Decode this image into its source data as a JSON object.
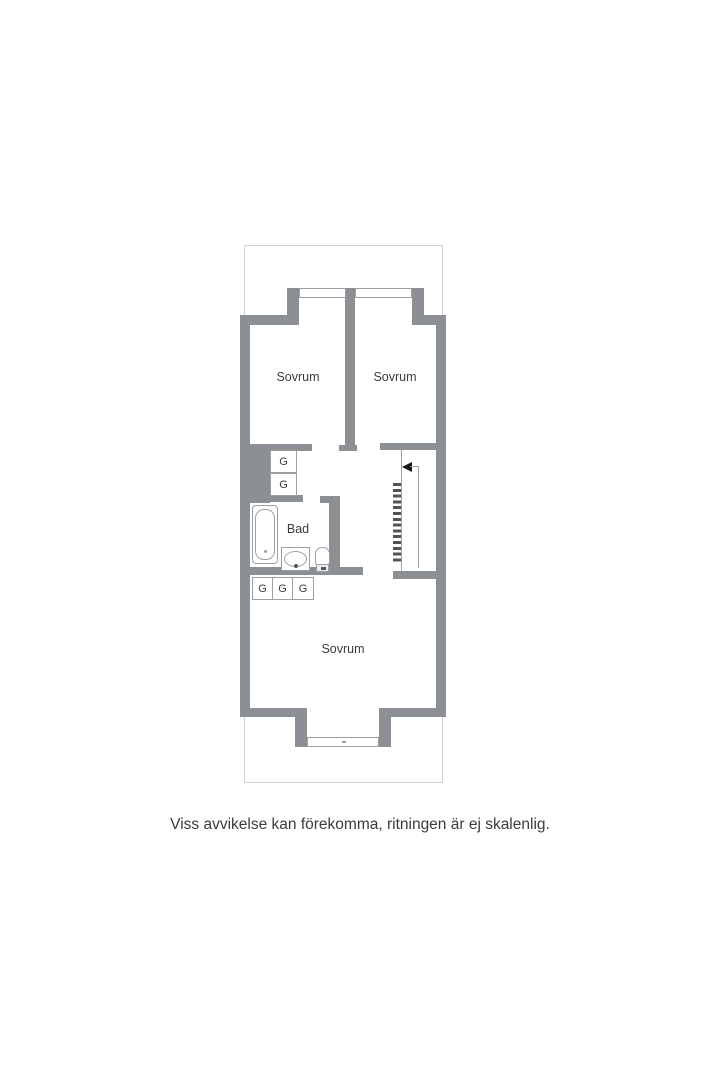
{
  "floorplan": {
    "rooms": {
      "bedroom_top_left": {
        "label": "Sovrum"
      },
      "bedroom_top_right": {
        "label": "Sovrum"
      },
      "bathroom": {
        "label": "Bad"
      },
      "bedroom_bottom": {
        "label": "Sovrum"
      }
    },
    "wardrobes": {
      "hall": [
        {
          "label": "G"
        },
        {
          "label": "G"
        }
      ],
      "bedroom": [
        {
          "label": "G"
        },
        {
          "label": "G"
        },
        {
          "label": "G"
        }
      ]
    },
    "caption": "Viss avvikelse kan förekomma, ritningen är ej skalenlig."
  },
  "colors": {
    "background": "#ffffff",
    "wall": "#8c9094",
    "line": "#9ba0a3",
    "boundary": "#cfd1d2",
    "text": "#3b3b3b",
    "tread": "#505356",
    "arrow": "#161616"
  }
}
